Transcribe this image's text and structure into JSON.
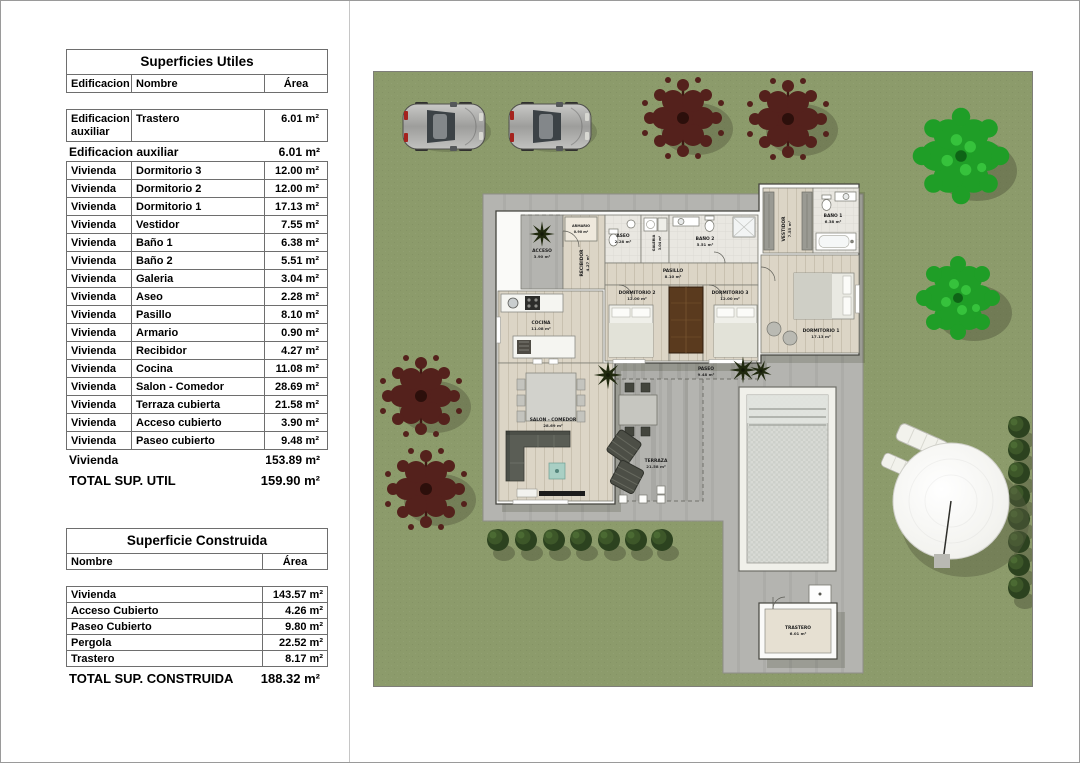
{
  "left_panel": {
    "useful_surfaces": {
      "title": "Superficies Utiles",
      "columns": {
        "edificacion": "Edificacion",
        "nombre": "Nombre",
        "area": "Área"
      },
      "aux_row": {
        "edificacion": "Edificacion auxiliar",
        "nombre": "Trastero",
        "area": "6.01 m²"
      },
      "aux_subtotal": {
        "label": "Edificacion auxiliar",
        "area": "6.01 m²"
      },
      "rows": [
        {
          "edificacion": "Vivienda",
          "nombre": "Dormitorio 3",
          "area": "12.00 m²"
        },
        {
          "edificacion": "Vivienda",
          "nombre": "Dormitorio 2",
          "area": "12.00 m²"
        },
        {
          "edificacion": "Vivienda",
          "nombre": "Dormitorio 1",
          "area": "17.13 m²"
        },
        {
          "edificacion": "Vivienda",
          "nombre": "Vestidor",
          "area": "7.55 m²"
        },
        {
          "edificacion": "Vivienda",
          "nombre": "Baño 1",
          "area": "6.38 m²"
        },
        {
          "edificacion": "Vivienda",
          "nombre": "Baño 2",
          "area": "5.51 m²"
        },
        {
          "edificacion": "Vivienda",
          "nombre": "Galeria",
          "area": "3.04 m²"
        },
        {
          "edificacion": "Vivienda",
          "nombre": "Aseo",
          "area": "2.28 m²"
        },
        {
          "edificacion": "Vivienda",
          "nombre": "Pasillo",
          "area": "8.10 m²"
        },
        {
          "edificacion": "Vivienda",
          "nombre": "Armario",
          "area": "0.90 m²"
        },
        {
          "edificacion": "Vivienda",
          "nombre": "Recibidor",
          "area": "4.27 m²"
        },
        {
          "edificacion": "Vivienda",
          "nombre": "Cocina",
          "area": "11.08 m²"
        },
        {
          "edificacion": "Vivienda",
          "nombre": "Salon - Comedor",
          "area": "28.69 m²"
        },
        {
          "edificacion": "Vivienda",
          "nombre": "Terraza cubierta",
          "area": "21.58 m²"
        },
        {
          "edificacion": "Vivienda",
          "nombre": "Acceso cubierto",
          "area": "3.90 m²"
        },
        {
          "edificacion": "Vivienda",
          "nombre": "Paseo cubierto",
          "area": "9.48 m²"
        }
      ],
      "vivienda_subtotal": {
        "label": "Vivienda",
        "area": "153.89 m²"
      },
      "total": {
        "label": "TOTAL SUP. UTIL",
        "area": "159.90 m²"
      }
    },
    "built_surface": {
      "title": "Superficie Construida",
      "columns": {
        "nombre": "Nombre",
        "area": "Área"
      },
      "rows": [
        {
          "nombre": "Vivienda",
          "area": "143.57 m²"
        },
        {
          "nombre": "Acceso Cubierto",
          "area": "4.26 m²"
        },
        {
          "nombre": "Paseo Cubierto",
          "area": "9.80 m²"
        },
        {
          "nombre": "Pergola",
          "area": "22.52 m²"
        },
        {
          "nombre": "Trastero",
          "area": "8.17 m²"
        }
      ],
      "total": {
        "label": "TOTAL SUP. CONSTRUIDA",
        "area": "188.32 m²"
      }
    }
  },
  "site_plan": {
    "rooms": {
      "acceso": {
        "name": "ACCESO",
        "area": "3.90 m²"
      },
      "recibidor": {
        "name": "RECIBIDOR",
        "area": "4.27 m²"
      },
      "armario": {
        "name": "ARMARIO",
        "area": "0.90 m²"
      },
      "aseo": {
        "name": "ASEO",
        "area": "2.28 m²"
      },
      "galeria": {
        "name": "GALERIA",
        "area": "3.04 m²"
      },
      "bano2": {
        "name": "BAÑO 2",
        "area": "5.51 m²"
      },
      "vestidor": {
        "name": "VESTIDOR",
        "area": "7.55 m²"
      },
      "bano1": {
        "name": "BAÑO 1",
        "area": "6.38 m²"
      },
      "pasillo": {
        "name": "PASILLO",
        "area": "8.10 m²"
      },
      "dorm2": {
        "name": "DORMITORIO 2",
        "area": "12.00 m²"
      },
      "dorm3": {
        "name": "DORMITORIO 3",
        "area": "12.00 m²"
      },
      "dorm1": {
        "name": "DORMITORIO 1",
        "area": "17.13 m²"
      },
      "cocina": {
        "name": "COCINA",
        "area": "11.08 m²"
      },
      "salon": {
        "name": "SALON - COMEDOR",
        "area": "28.69 m²"
      },
      "terraza": {
        "name": "TERRAZA",
        "area": "21.58 m²"
      },
      "paseo": {
        "name": "PASEO",
        "area": "9.48 m²"
      },
      "trastero": {
        "name": "TRASTERO",
        "area": "6.01 m²"
      }
    },
    "colors": {
      "lawn": "#8c9b6b",
      "paving": "#b4b4b0",
      "pool_water": "#d8dad5",
      "tree_green": "#1f9e27",
      "tree_maroon": "#54211c",
      "bush": "#2c421f",
      "wall": "#fafaf8",
      "wood_floor": "#dcd5c6"
    }
  }
}
